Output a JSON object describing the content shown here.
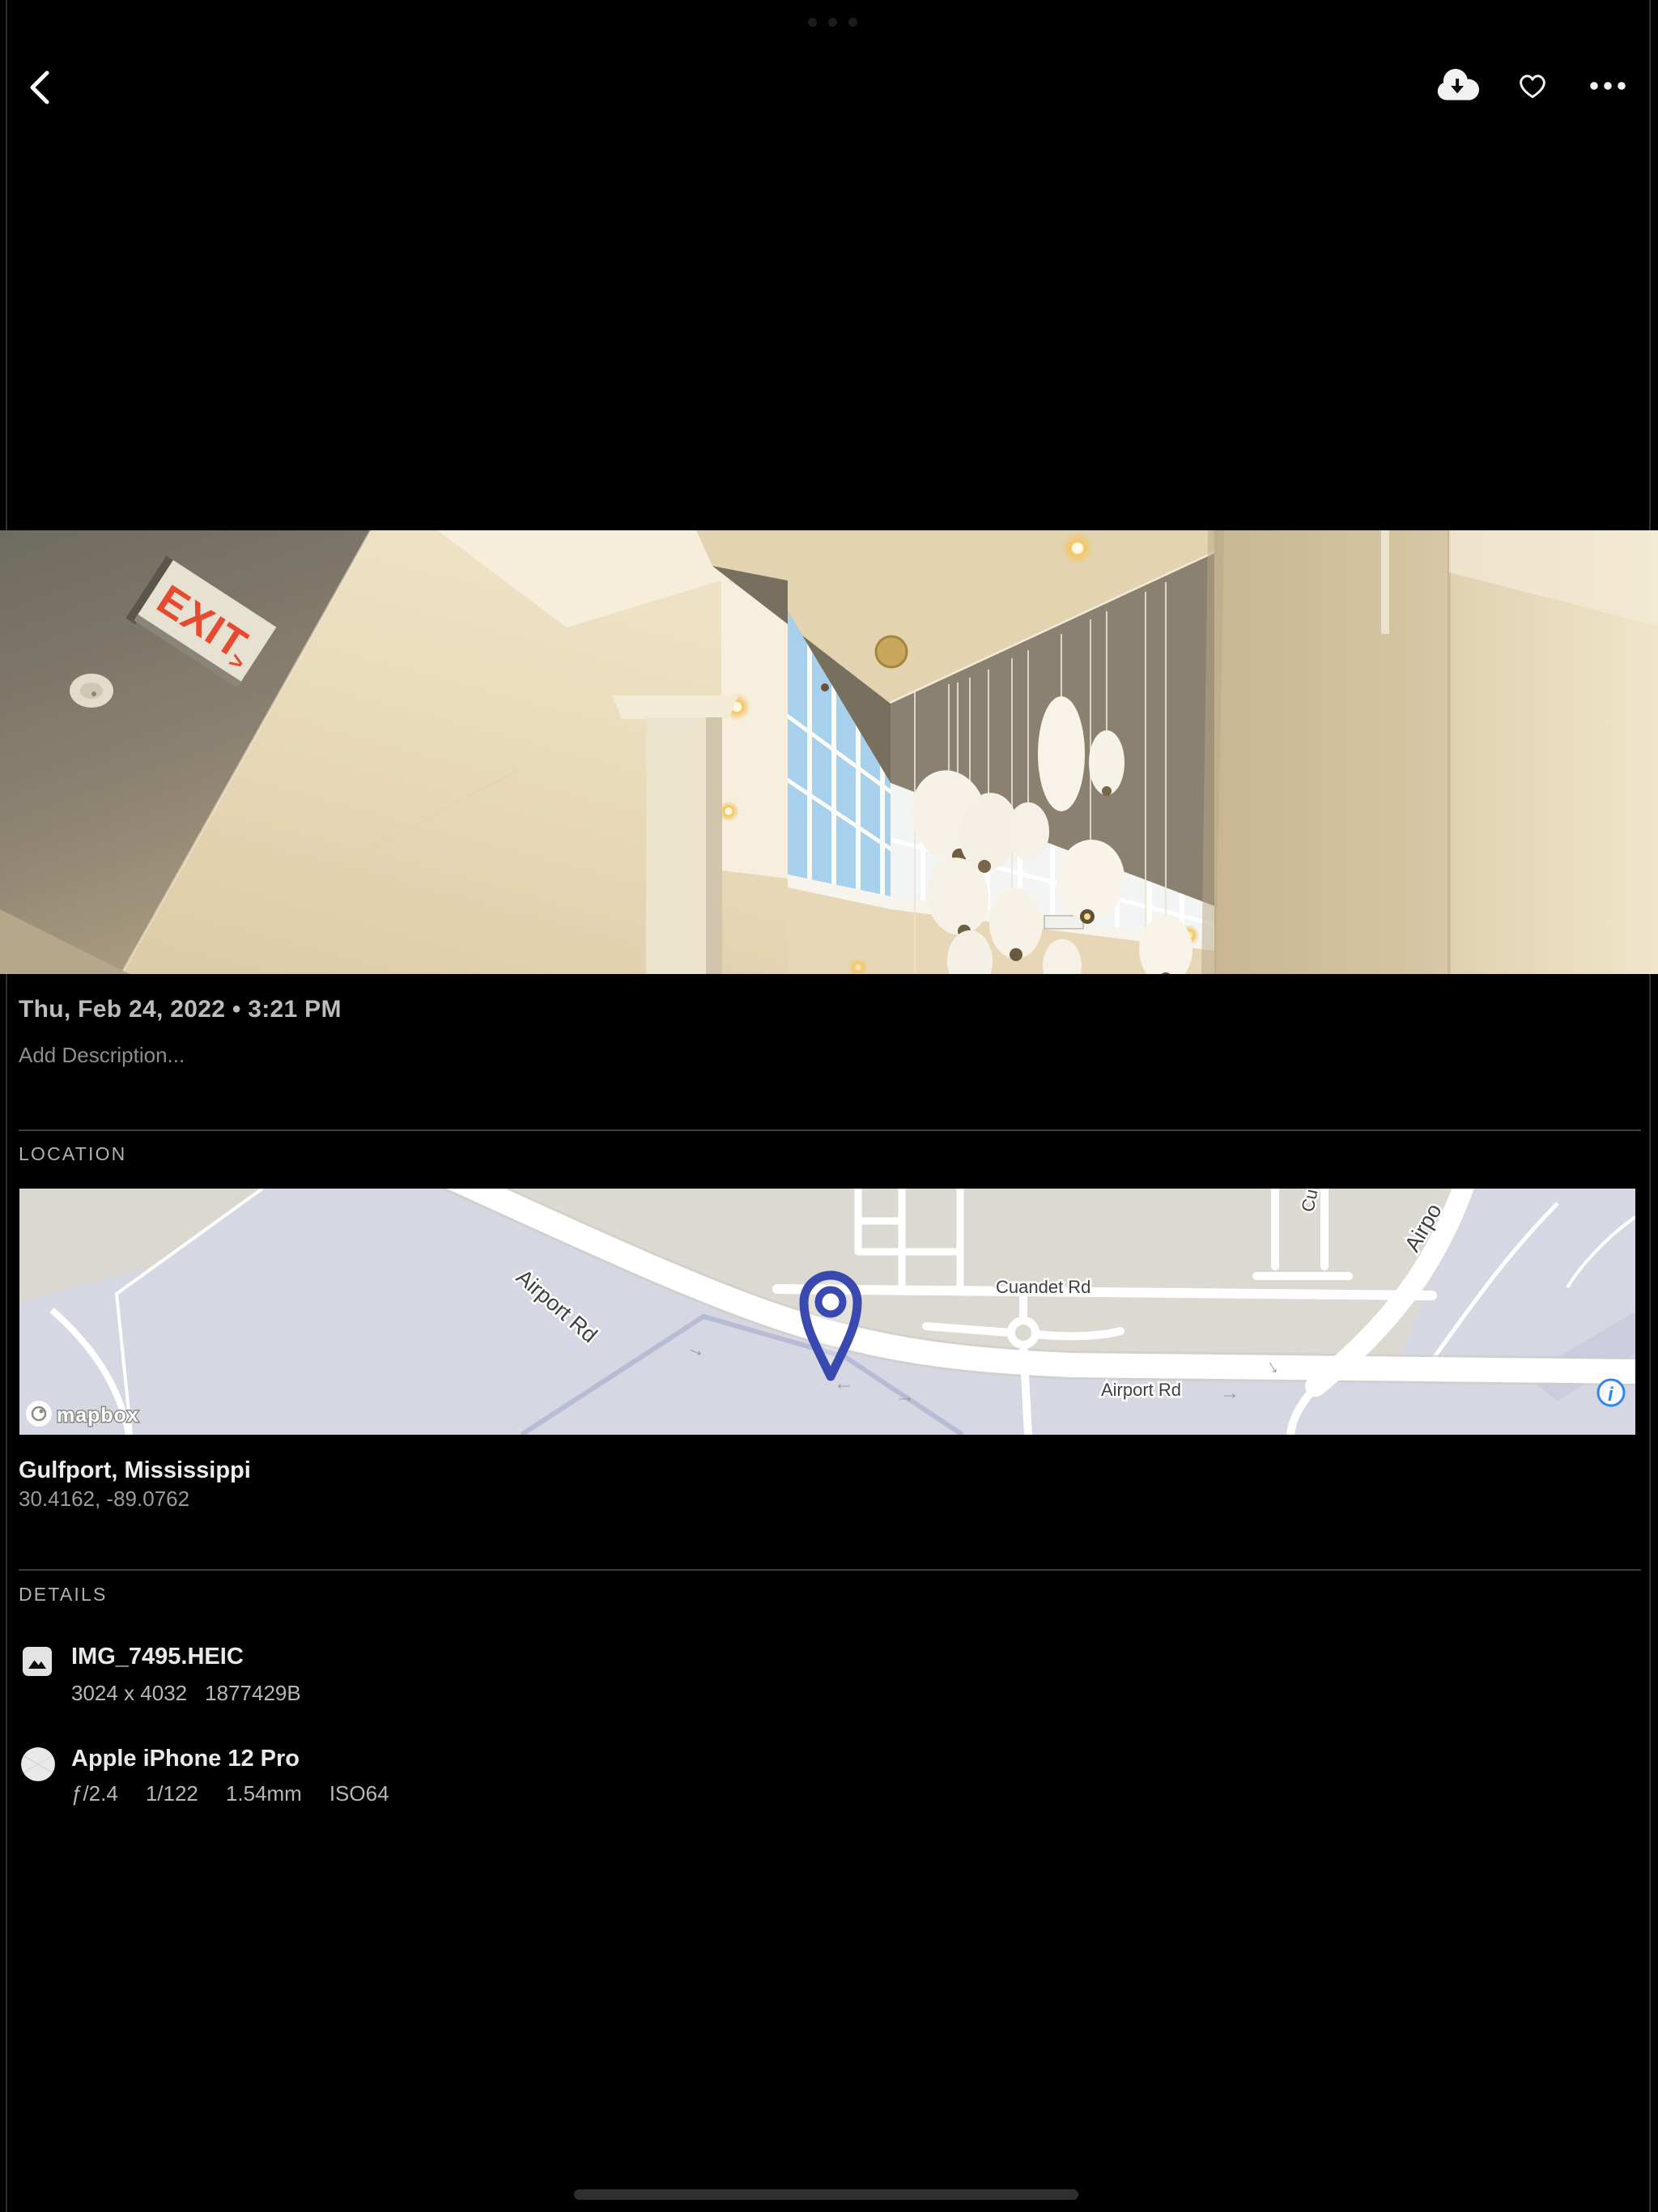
{
  "header": {
    "icons": {
      "back": "chevron-left",
      "download": "cloud-arrow-down",
      "favorite": "heart-outline",
      "more": "ellipsis"
    }
  },
  "photo": {
    "date_taken": "Thu, Feb 24, 2022 • 3:21 PM",
    "description_placeholder": "Add Description...",
    "exit_sign": "EXIT",
    "exit_arrow": ">",
    "exit_red": "#e64a31"
  },
  "location": {
    "section_label": "LOCATION",
    "place": "Gulfport, Mississippi",
    "coordinates": "30.4162, -89.0762",
    "map": {
      "labels": [
        "Airport Rd",
        "Cuandet Rd",
        "Airport Rd",
        "Cu",
        "Airpo"
      ],
      "arrows": [
        "→",
        "←",
        "→",
        "→",
        "→"
      ],
      "attribution": "mapbox",
      "info_glyph": "i",
      "colors": {
        "land": "#dcd9d2",
        "airfield": "#d5d7e3",
        "road": "#ffffff",
        "pin": "#3a49b0",
        "info_blue": "#2e86f0",
        "label_text": "#3f3f3f"
      }
    }
  },
  "details": {
    "section_label": "DETAILS",
    "file": {
      "name": "IMG_7495.HEIC",
      "dimensions": "3024 x 4032",
      "size": "1877429B"
    },
    "camera": {
      "name": "Apple iPhone 12 Pro",
      "aperture": "ƒ/2.4",
      "shutter": "1/122",
      "focal_length": "1.54mm",
      "iso": "ISO64"
    }
  }
}
